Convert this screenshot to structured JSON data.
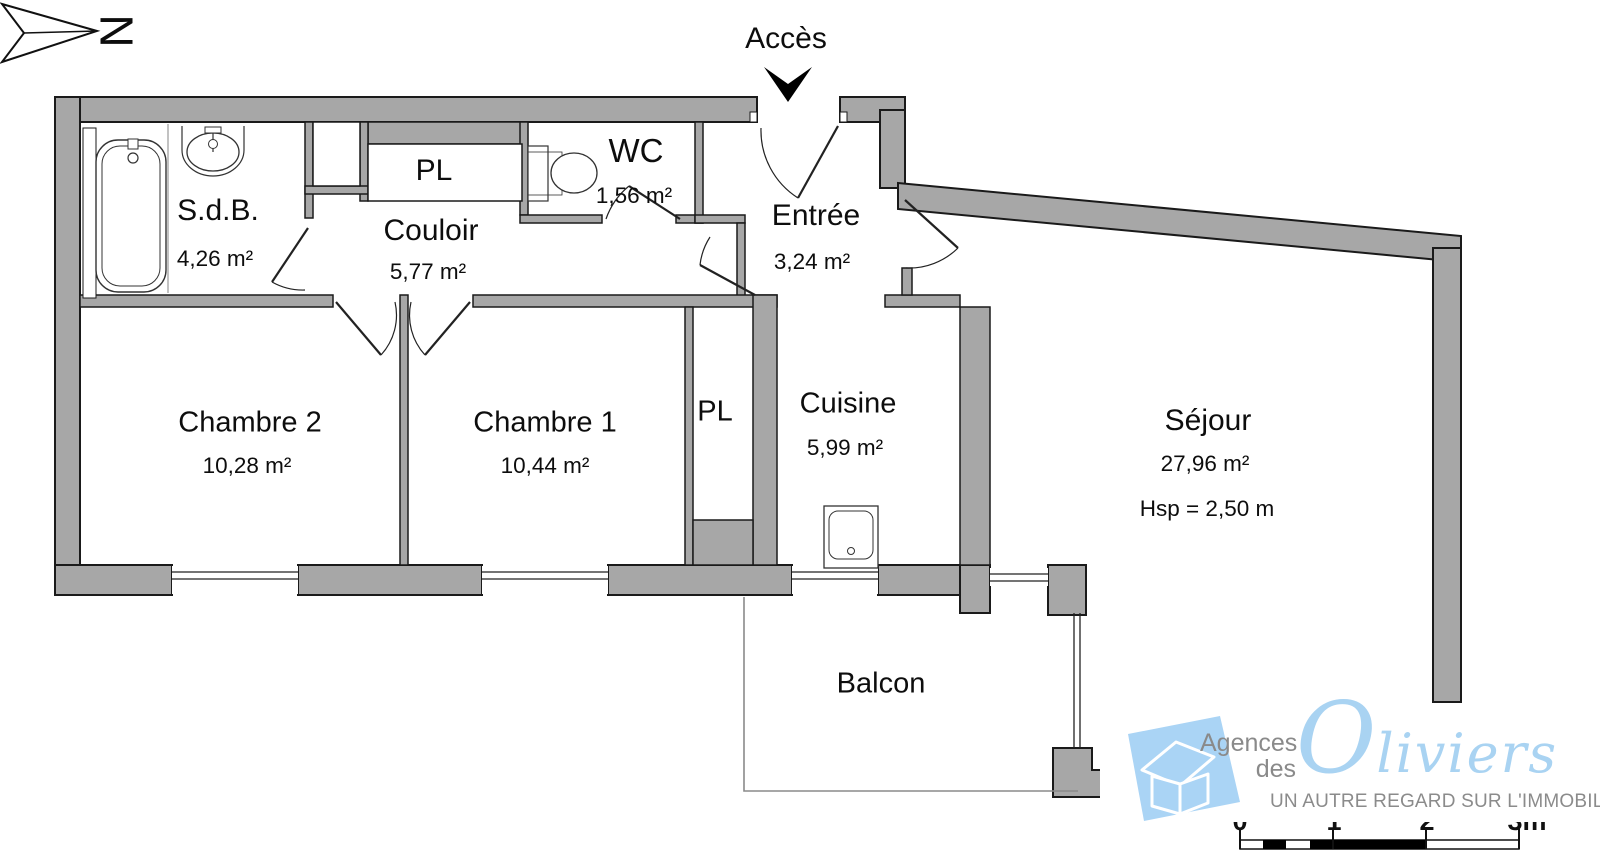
{
  "north_label": "N",
  "access": {
    "label": "Accès"
  },
  "rooms": {
    "sdb": {
      "name": "S.d.B.",
      "area": "4,26 m²"
    },
    "couloir": {
      "name": "Couloir",
      "area": "5,77 m²"
    },
    "pl_top": {
      "name": "PL"
    },
    "wc": {
      "name": "WC",
      "area": "1,56 m²"
    },
    "entree": {
      "name": "Entrée",
      "area": "3,24 m²"
    },
    "chambre2": {
      "name": "Chambre 2",
      "area": "10,28 m²"
    },
    "chambre1": {
      "name": "Chambre 1",
      "area": "10,44 m²"
    },
    "pl_bottom": {
      "name": "PL"
    },
    "cuisine": {
      "name": "Cuisine",
      "area": "5,99 m²"
    },
    "sejour": {
      "name": "Séjour",
      "area": "27,96 m²",
      "ceiling_height": "Hsp = 2,50 m"
    },
    "balcon": {
      "name": "Balcon"
    }
  },
  "logo": {
    "agency_line1": "Agences",
    "agency_line2": "des",
    "brand_initial": "O",
    "brand_rest": "liviers",
    "tagline": "UN AUTRE REGARD SUR L'IMMOBILIER"
  },
  "scale_bar": {
    "labels": [
      "0",
      "1",
      "2",
      "3m"
    ]
  },
  "colors": {
    "wall_gray": "#a7a7a7",
    "outline": "#1a1a1a",
    "logo_blue": "#a9d3f2",
    "logo_text_gray": "#8b8b8b"
  }
}
